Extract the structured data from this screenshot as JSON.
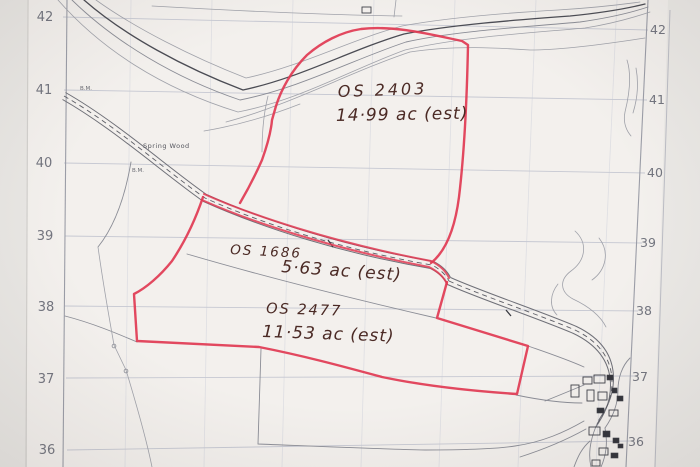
{
  "photo": {
    "grid_labels_left": [
      "42",
      "41",
      "40",
      "39",
      "38",
      "37",
      "36"
    ],
    "grid_labels_right": [
      "42",
      "41",
      "40",
      "39",
      "38",
      "37",
      "36"
    ],
    "parcels": [
      {
        "os_number": "OS 2403",
        "area_label": "14·99 ac (est)"
      },
      {
        "os_number": "OS 1686",
        "area_label": "5·63 ac (est)"
      },
      {
        "os_number": "OS 2477",
        "area_label": "11·53 ac (est)"
      }
    ],
    "place_labels": {
      "wood": "Spring Wood",
      "benchmark_1": "B.M.",
      "benchmark_2": "B.M."
    },
    "colors": {
      "paper": "#f3f0ed",
      "parcel_outline": "#e13a52",
      "handwriting": "#4b2a25",
      "map_line": "#8b8d96"
    }
  }
}
